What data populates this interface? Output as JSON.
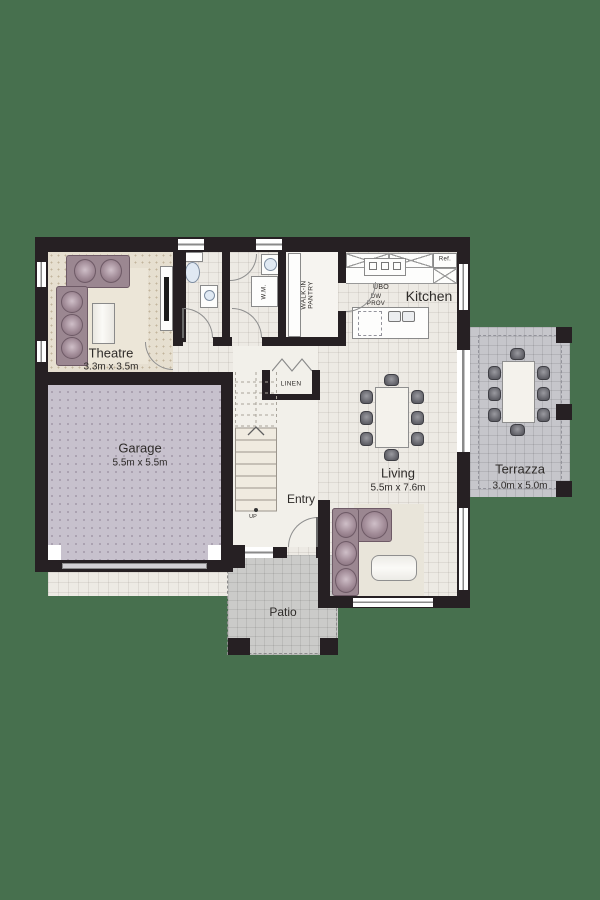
{
  "plan_title": "Ground floor plan",
  "colors": {
    "background": "#47704E",
    "walls": "#262023",
    "tile_floor": "#edeae4",
    "theatre_carpet": "#e6dfd0",
    "garage_floor": "#c7c1cd",
    "patio_floor": "#cbcbc9",
    "terrazza_floor": "#c6c6cb",
    "furniture": "#9b8791"
  },
  "rooms": {
    "theatre": {
      "name": "Theatre",
      "dims": "3.3m x 3.5m"
    },
    "garage": {
      "name": "Garage",
      "dims": "5.5m x 5.5m"
    },
    "kitchen": {
      "name": "Kitchen"
    },
    "living": {
      "name": "Living",
      "dims": "5.5m x 7.6m"
    },
    "terrazza": {
      "name": "Terrazza",
      "dims": "3.0m x 5.0m"
    },
    "entry": {
      "name": "Entry"
    },
    "patio": {
      "name": "Patio"
    },
    "linen": {
      "name": "LINEN"
    },
    "pantry": {
      "line1": "WALK-IN",
      "line2": "PANTRY"
    }
  },
  "fixtures": {
    "washing_machine": "W.M.",
    "under_bench_oven": "UBO",
    "fridge": "Ref.",
    "dishwasher_line1": "DW",
    "dishwasher_line2": "PROV",
    "stairs_direction": "UP"
  }
}
